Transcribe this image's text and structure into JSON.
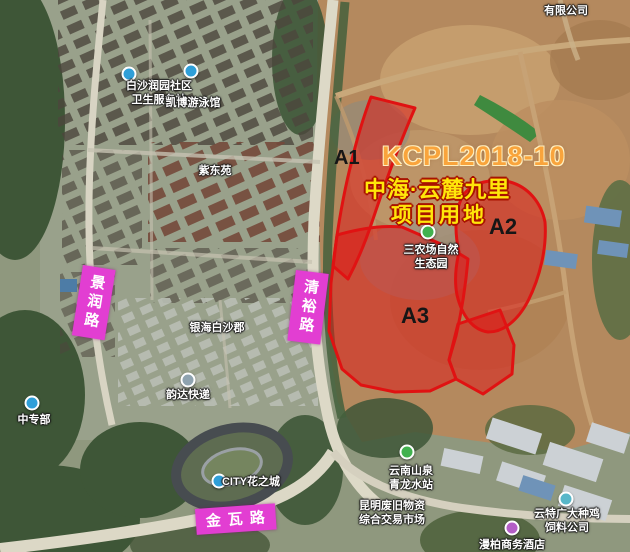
{
  "overlay": {
    "parcel_code": "KCPL2018-10",
    "project_name": "中海·云麓九里",
    "project_label": "项目用地",
    "zones": [
      {
        "id": "A1"
      },
      {
        "id": "A2"
      },
      {
        "id": "A3"
      }
    ]
  },
  "roads": [
    {
      "id": "jingrun",
      "name": "景润路"
    },
    {
      "id": "qingyu",
      "name": "清裕路"
    },
    {
      "id": "jinwa",
      "name": "金瓦路"
    }
  ],
  "places": {
    "health_station": {
      "line1": "白沙润园社区",
      "line2": "卫生服务站"
    },
    "swimming_pool": {
      "line1": "凯博游泳馆"
    },
    "zidongyuan": {
      "line1": "紫东苑"
    },
    "yinhai_baishajun": {
      "line1": "银海白沙郡"
    },
    "yunda_express": {
      "line1": "韵达快递"
    },
    "zhongzhuanbu": {
      "line1": "中专部"
    },
    "city_flower_town": {
      "line1": "CITY花之城"
    },
    "sannong_ecopark": {
      "line1": "三农场自然",
      "line2": "生态园"
    },
    "yunnan_shanquan": {
      "line1": "云南山泉",
      "line2": "青龙水站"
    },
    "recycle_market": {
      "line1": "昆明废旧物资",
      "line2": "综合交易市场"
    },
    "breeder_feed_co": {
      "line1": "云特广大种鸡",
      "line2": "饲料公司"
    },
    "limited_company": {
      "line1": "有限公司"
    },
    "hotel": {
      "line1": "漫柏商务酒店"
    }
  },
  "colors": {
    "zone_fill": "#e01414",
    "zone_border": "#e01212",
    "road_label_bg": "#e23ed2",
    "parcel_code_text": "#f9a43c",
    "project_name_text": "#ffe60a",
    "poi_green_icon": "#41b14e",
    "poi_blue_icon": "#2f9fd8",
    "poi_purple_icon": "#b45ec6"
  }
}
